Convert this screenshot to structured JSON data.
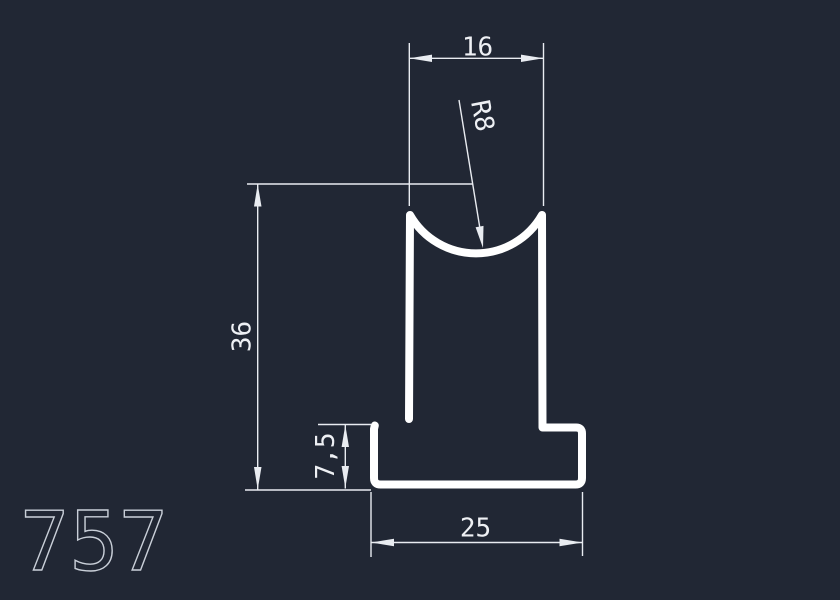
{
  "drawing": {
    "part_number": "757",
    "description": "CAD drawing of a T-shaped extrusion profile with a concave radius channel on top",
    "dimensions": [
      {
        "name": "top-width",
        "label": "16",
        "value": 16,
        "type": "linear-horizontal",
        "position": "top"
      },
      {
        "name": "top-radius",
        "label": "R8",
        "value": 8,
        "type": "radius-leader",
        "position": "top-center"
      },
      {
        "name": "overall-height",
        "label": "36",
        "value": 36,
        "type": "linear-vertical",
        "position": "left"
      },
      {
        "name": "flange-height",
        "label": "7,5",
        "value": 7.5,
        "type": "linear-vertical",
        "position": "bottom-left"
      },
      {
        "name": "base-width",
        "label": "25",
        "value": 25,
        "type": "linear-horizontal",
        "position": "bottom"
      }
    ],
    "colors": {
      "background": "#212734",
      "profile_outline": "#ffffff",
      "dimension_lines": "#e9ecf1",
      "part_number_text": "#c9cfd8"
    }
  }
}
